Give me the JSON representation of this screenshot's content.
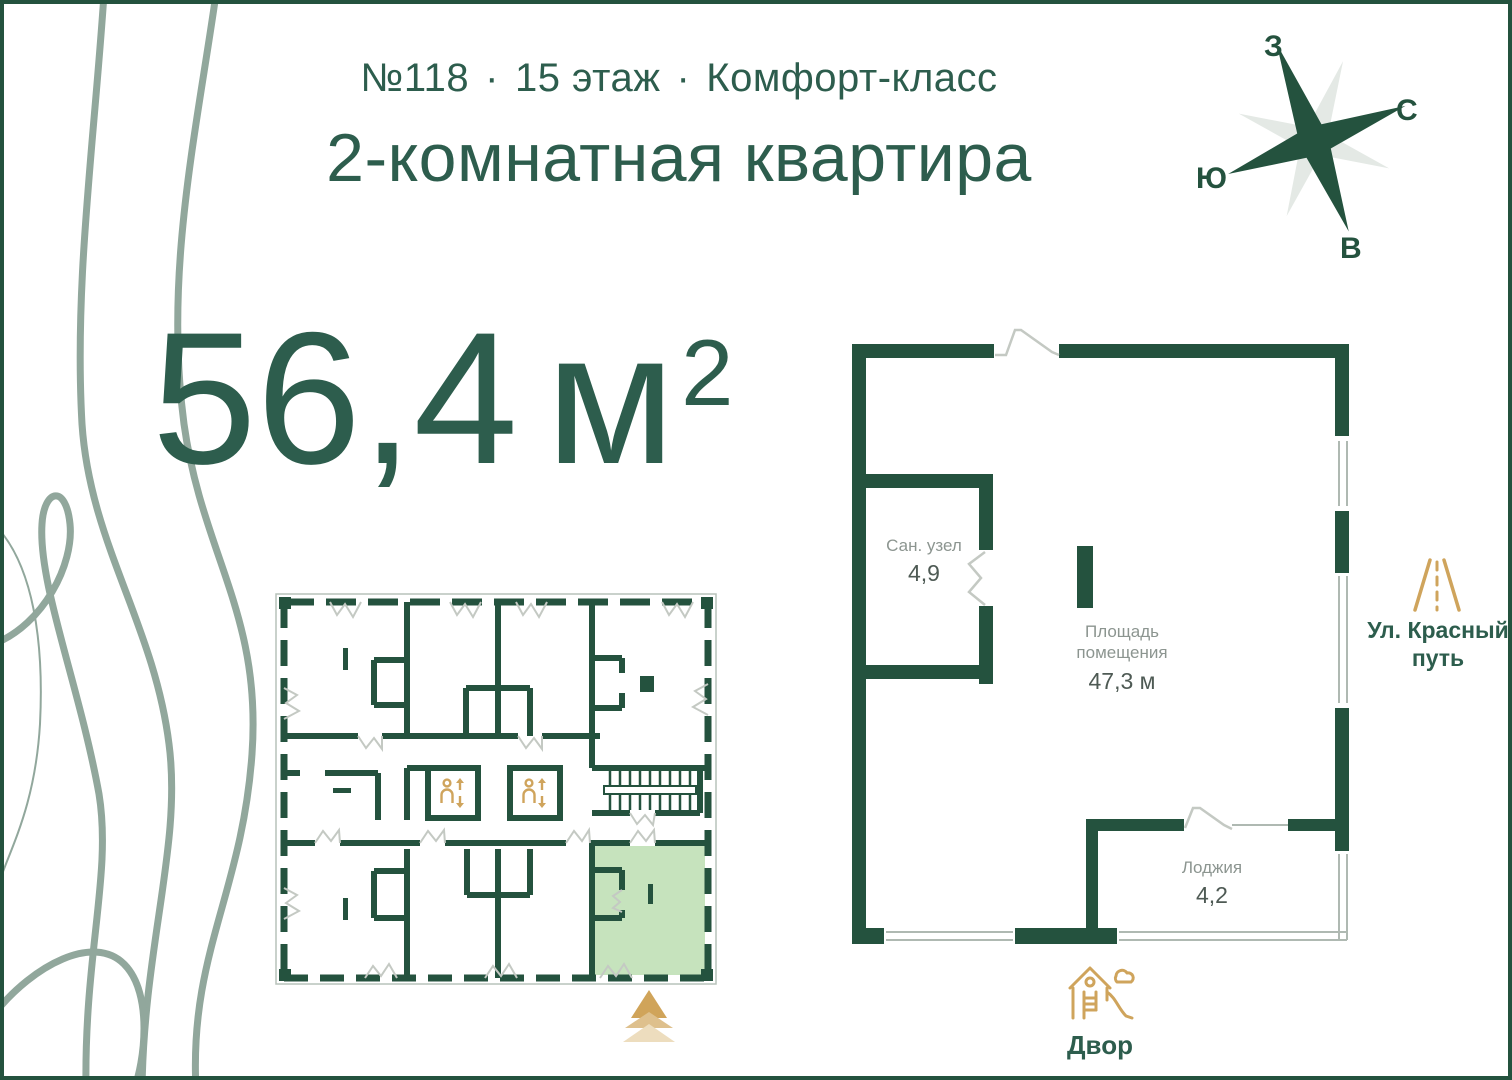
{
  "header": {
    "apartment_number": "№118",
    "separator": "·",
    "floor": "15 этаж",
    "class": "Комфорт-класс",
    "subtitle": "2-комнатная квартира"
  },
  "total_area": {
    "value": "56,4",
    "unit": "м",
    "superscript": "2"
  },
  "compass": {
    "west": "З",
    "north": "С",
    "south": "Ю",
    "east": "В"
  },
  "floor_plan": {
    "bathroom": {
      "label": "Сан. узел",
      "area": "4,9"
    },
    "main_room": {
      "label": "Площадь помещения",
      "area": "47,3 м"
    },
    "loggia": {
      "label": "Лоджия",
      "area": "4,2"
    }
  },
  "landmarks": {
    "street": "Ул. Красный путь",
    "yard": "Двор"
  },
  "colors": {
    "green_text": "#2D5D4D",
    "wall_green": "#24523E",
    "gold": "#CFA45C",
    "highlight_green": "#C6E3BD",
    "label_gray": "#8C9590",
    "wave_gray": "#91A79C"
  }
}
